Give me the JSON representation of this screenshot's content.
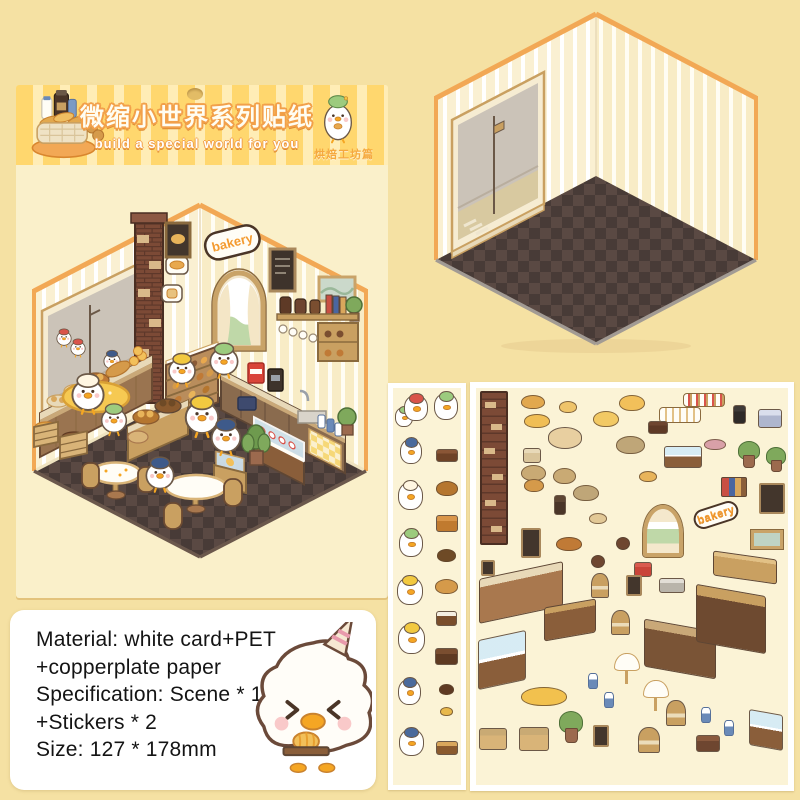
{
  "colors": {
    "page_bg": "#F5E1A3",
    "banner_yellow": "#FFD76E",
    "banner_pale": "#FFEDB6",
    "title_fill": "#FFFDF2",
    "title_outline": "#F2A04A",
    "edition_orange": "#F5A93F",
    "card_body": "#FAF0CA",
    "trim_orange": "#F2A855",
    "wall_cream": "#FAF0D2",
    "floor_dark": "#483B37",
    "floor_light": "#5A4943",
    "wood": "#A9784E",
    "sign_orange": "#F49A2E",
    "duck_white": "#FFFFFF",
    "sheet_bg": "#FBF3D6"
  },
  "banner": {
    "title": "微缩小世界系列贴纸",
    "subtitle": "build a special world for you",
    "edition": "烘焙工坊篇"
  },
  "scene": {
    "sign": "bakery"
  },
  "info_box": {
    "lines": [
      "Material: white card+PET",
      "+copperplate paper",
      "Specification: Scene * 1",
      "+Stickers * 2",
      "Size: 127 * 178mm"
    ]
  },
  "sticker_sheets": {
    "sheet_small": {
      "items": [
        {
          "n": "duck-green-small",
          "t": "duck",
          "c": "#9CCB7E",
          "x": 1,
          "y": 18,
          "w": 18,
          "h": 20
        },
        {
          "n": "duck-red-beret",
          "t": "duck",
          "c": "#D9534A",
          "x": 10,
          "y": 6,
          "w": 24,
          "h": 26
        },
        {
          "n": "duck-green-beret",
          "t": "duck",
          "c": "#9CCB7E",
          "x": 40,
          "y": 4,
          "w": 24,
          "h": 27
        },
        {
          "n": "duck-navy-cap",
          "t": "duck",
          "c": "#4A6A9C",
          "x": 6,
          "y": 50,
          "w": 22,
          "h": 25
        },
        {
          "n": "chocolate-tray",
          "t": "box",
          "c": "#6E4226",
          "c2": "#8A5636",
          "x": 42,
          "y": 60,
          "w": 22,
          "h": 13
        },
        {
          "n": "duck-cream-hat",
          "t": "duck",
          "c": "#FFF6E2",
          "x": 4,
          "y": 93,
          "w": 25,
          "h": 28
        },
        {
          "n": "bread-rolls",
          "t": "blob",
          "c": "#B5762F",
          "x": 42,
          "y": 92,
          "w": 22,
          "h": 15
        },
        {
          "n": "waffle-stack",
          "t": "box",
          "c": "#C07A2F",
          "c2": "#D9954A",
          "x": 42,
          "y": 126,
          "w": 22,
          "h": 17
        },
        {
          "n": "duck-green-eating",
          "t": "duck",
          "c": "#9CCB7E",
          "x": 5,
          "y": 141,
          "w": 24,
          "h": 27
        },
        {
          "n": "cookies",
          "t": "blob",
          "c": "#6E4A26",
          "x": 43,
          "y": 160,
          "w": 19,
          "h": 13
        },
        {
          "n": "duck-yellow-beret",
          "t": "duck",
          "c": "#F2C940",
          "x": 3,
          "y": 188,
          "w": 26,
          "h": 28
        },
        {
          "n": "croissants",
          "t": "blob",
          "c": "#D59A4A",
          "x": 41,
          "y": 190,
          "w": 23,
          "h": 15
        },
        {
          "n": "cupcakes-pair",
          "t": "box",
          "c": "#7A4E2C",
          "c2": "#F5EFE2",
          "x": 42,
          "y": 222,
          "w": 21,
          "h": 15
        },
        {
          "n": "duck-with-bag",
          "t": "duck",
          "c": "#F2C940",
          "x": 4,
          "y": 235,
          "w": 27,
          "h": 30
        },
        {
          "n": "chocolate-bars",
          "t": "box",
          "c": "#5E3A22",
          "c2": "#7A4E30",
          "x": 41,
          "y": 259,
          "w": 23,
          "h": 17
        },
        {
          "n": "duck-sailor",
          "t": "duck",
          "c": "#4A6A9C",
          "x": 4,
          "y": 290,
          "w": 23,
          "h": 26
        },
        {
          "n": "choco-drops",
          "t": "blob",
          "c": "#5E3A22",
          "x": 45,
          "y": 295,
          "w": 15,
          "h": 11
        },
        {
          "n": "butter-slices",
          "t": "blob",
          "c": "#E8B84B",
          "x": 46,
          "y": 318,
          "w": 13,
          "h": 9
        },
        {
          "n": "duck-waving",
          "t": "duck",
          "c": "#4A6A9C",
          "x": 5,
          "y": 340,
          "w": 25,
          "h": 27
        },
        {
          "n": "bread-loaf",
          "t": "box",
          "c": "#8A5A2E",
          "c2": "#D9A75C",
          "x": 42,
          "y": 352,
          "w": 22,
          "h": 14
        }
      ]
    },
    "sheet_large": {
      "items": [
        {
          "n": "brick-column",
          "t": "column",
          "x": 3,
          "y": 2,
          "w": 28,
          "h": 154
        },
        {
          "n": "bread-pair",
          "t": "blob",
          "c": "#E2A84E",
          "x": 44,
          "y": 6,
          "w": 24,
          "h": 14
        },
        {
          "n": "cupcake-duo",
          "t": "blob",
          "c": "#EFC46A",
          "x": 82,
          "y": 12,
          "w": 18,
          "h": 12
        },
        {
          "n": "buns-trio",
          "t": "blob",
          "c": "#F0BE55",
          "x": 47,
          "y": 25,
          "w": 26,
          "h": 14
        },
        {
          "n": "buns-quad",
          "t": "blob",
          "c": "#F2C964",
          "x": 116,
          "y": 22,
          "w": 26,
          "h": 16
        },
        {
          "n": "big-buns",
          "t": "blob",
          "c": "#F2C05A",
          "x": 142,
          "y": 6,
          "w": 26,
          "h": 16
        },
        {
          "n": "picnic-table",
          "t": "table",
          "c": "#E8CFA0",
          "x": 71,
          "y": 38,
          "w": 34,
          "h": 22
        },
        {
          "n": "cupcake-row-white",
          "t": "cuprow",
          "x": 182,
          "y": 18,
          "w": 42,
          "h": 16
        },
        {
          "n": "cupcake-row-berry",
          "t": "cuprow2",
          "x": 206,
          "y": 4,
          "w": 42,
          "h": 14
        },
        {
          "n": "kitchen-scale",
          "t": "box",
          "c": "#2E2A28",
          "c2": "#3E3A38",
          "x": 256,
          "y": 16,
          "w": 13,
          "h": 19
        },
        {
          "n": "cash-register",
          "t": "box",
          "c": "#AEB6CE",
          "c2": "#D9DEEC",
          "x": 281,
          "y": 20,
          "w": 24,
          "h": 19
        },
        {
          "n": "jar-cabinet",
          "t": "box",
          "c": "#5E3A26",
          "c2": "#6E4630",
          "x": 171,
          "y": 32,
          "w": 20,
          "h": 13
        },
        {
          "n": "jar-basket",
          "t": "box",
          "c": "#D9C49A",
          "c2": "#E8D9B8",
          "x": 46,
          "y": 59,
          "w": 18,
          "h": 15
        },
        {
          "n": "flour-sack-1",
          "t": "blob",
          "c": "#C9AA74",
          "x": 44,
          "y": 76,
          "w": 25,
          "h": 16
        },
        {
          "n": "flour-sack-2",
          "t": "blob",
          "c": "#C9AA74",
          "x": 76,
          "y": 79,
          "w": 23,
          "h": 16
        },
        {
          "n": "dough-mat",
          "t": "blob",
          "c": "#BFA678",
          "x": 139,
          "y": 47,
          "w": 29,
          "h": 18
        },
        {
          "n": "sandwich-case",
          "t": "case",
          "x": 187,
          "y": 57,
          "w": 38,
          "h": 22
        },
        {
          "n": "sushi-rolls",
          "t": "blob",
          "c": "#D9A0A8",
          "x": 227,
          "y": 50,
          "w": 22,
          "h": 11
        },
        {
          "n": "plant-1",
          "t": "plant",
          "x": 261,
          "y": 52,
          "w": 20,
          "h": 27
        },
        {
          "n": "plant-2",
          "t": "plant",
          "x": 289,
          "y": 58,
          "w": 18,
          "h": 25
        },
        {
          "n": "croissant-pair",
          "t": "blob",
          "c": "#D59A4A",
          "x": 47,
          "y": 90,
          "w": 20,
          "h": 13
        },
        {
          "n": "mini-buns",
          "t": "blob",
          "c": "#E8B45A",
          "x": 162,
          "y": 82,
          "w": 18,
          "h": 11
        },
        {
          "n": "books-stack",
          "t": "books",
          "x": 244,
          "y": 88,
          "w": 26,
          "h": 20
        },
        {
          "n": "menu-chalkboard",
          "t": "board",
          "x": 282,
          "y": 94,
          "w": 26,
          "h": 31
        },
        {
          "n": "dough-mat-2",
          "t": "blob",
          "c": "#BFA678",
          "x": 96,
          "y": 96,
          "w": 26,
          "h": 16
        },
        {
          "n": "pepper-grinders",
          "t": "box",
          "c": "#4A3528",
          "c2": "#5E4634",
          "x": 77,
          "y": 106,
          "w": 12,
          "h": 20
        },
        {
          "n": "cutting-board",
          "t": "blob",
          "c": "#E2C896",
          "x": 112,
          "y": 124,
          "w": 18,
          "h": 11
        },
        {
          "n": "arch-window",
          "t": "arch",
          "x": 166,
          "y": 116,
          "w": 40,
          "h": 52
        },
        {
          "n": "bakery-sign",
          "t": "sign",
          "label": "bakery",
          "x": 216,
          "y": 116,
          "w": 46,
          "h": 20,
          "r": -18
        },
        {
          "n": "landscape-frame",
          "t": "frame",
          "x": 274,
          "y": 141,
          "w": 32,
          "h": 19
        },
        {
          "n": "duck-portrait",
          "t": "board",
          "x": 44,
          "y": 139,
          "w": 20,
          "h": 30
        },
        {
          "n": "bread-basket",
          "t": "blob",
          "c": "#C07A36",
          "x": 79,
          "y": 148,
          "w": 26,
          "h": 14
        },
        {
          "n": "stool-1",
          "t": "round",
          "c": "#6E4630",
          "x": 139,
          "y": 148,
          "w": 14,
          "h": 13
        },
        {
          "n": "stool-2",
          "t": "round",
          "c": "#6E4630",
          "x": 114,
          "y": 166,
          "w": 14,
          "h": 13
        },
        {
          "n": "radio",
          "t": "box",
          "c": "#C94438",
          "c2": "#D95A4E",
          "x": 157,
          "y": 173,
          "w": 18,
          "h": 15
        },
        {
          "n": "wall-cabinet",
          "t": "counter",
          "c": "#C9A061",
          "c2": "#E2C186",
          "x": 236,
          "y": 166,
          "w": 64,
          "h": 25,
          "s": 8
        },
        {
          "n": "photo-frame",
          "t": "board",
          "x": 4,
          "y": 171,
          "w": 14,
          "h": 16
        },
        {
          "n": "long-counter",
          "t": "counter",
          "c": "#A9784E",
          "c2": "#E8D9B8",
          "x": 2,
          "y": 181,
          "w": 84,
          "h": 45,
          "s": -12
        },
        {
          "n": "cafe-chair-1",
          "t": "chair",
          "c": "#C9A061",
          "x": 114,
          "y": 184,
          "w": 18,
          "h": 25
        },
        {
          "n": "easel-frame",
          "t": "board",
          "x": 149,
          "y": 186,
          "w": 16,
          "h": 21
        },
        {
          "n": "sink-unit",
          "t": "box",
          "c": "#B9B4AA",
          "c2": "#E2DED6",
          "x": 182,
          "y": 189,
          "w": 26,
          "h": 15
        },
        {
          "n": "booth-bench",
          "t": "counter",
          "c": "#8A5E3A",
          "c2": "#C9A061",
          "x": 67,
          "y": 214,
          "w": 52,
          "h": 34,
          "s": -10
        },
        {
          "n": "cafe-chair-2",
          "t": "chair",
          "c": "#C9A061",
          "x": 134,
          "y": 221,
          "w": 19,
          "h": 25
        },
        {
          "n": "curved-counter",
          "t": "counter",
          "c": "#7A5436",
          "c2": "#C9A878",
          "x": 167,
          "y": 236,
          "w": 72,
          "h": 48,
          "s": 10
        },
        {
          "n": "shelf-unit",
          "t": "counter",
          "c": "#6E4A30",
          "c2": "#C9A061",
          "x": 219,
          "y": 201,
          "w": 70,
          "h": 58,
          "s": 10
        },
        {
          "n": "bread-display-case",
          "t": "case",
          "x": 1,
          "y": 246,
          "w": 48,
          "h": 50,
          "s": -12
        },
        {
          "n": "umbrella-1",
          "t": "umbrella",
          "x": 137,
          "y": 264,
          "w": 24,
          "h": 31
        },
        {
          "n": "umbrella-2",
          "t": "umbrella",
          "x": 166,
          "y": 291,
          "w": 24,
          "h": 31
        },
        {
          "n": "yellow-rug",
          "t": "blob",
          "c": "#F2C14E",
          "x": 44,
          "y": 298,
          "w": 46,
          "h": 19
        },
        {
          "n": "milk-bottles-1",
          "t": "bottle",
          "x": 111,
          "y": 284,
          "w": 10,
          "h": 16
        },
        {
          "n": "milk-bottles-2",
          "t": "bottle",
          "x": 127,
          "y": 303,
          "w": 10,
          "h": 16
        },
        {
          "n": "milk-bottles-3",
          "t": "bottle",
          "x": 224,
          "y": 318,
          "w": 10,
          "h": 16
        },
        {
          "n": "milk-bottles-4",
          "t": "bottle",
          "x": 247,
          "y": 331,
          "w": 10,
          "h": 16
        },
        {
          "n": "potted-palm",
          "t": "plant",
          "x": 82,
          "y": 322,
          "w": 22,
          "h": 32
        },
        {
          "n": "bread-crate-1",
          "t": "box",
          "c": "#D9B478",
          "c2": "#C9AA74",
          "x": 2,
          "y": 339,
          "w": 28,
          "h": 22
        },
        {
          "n": "bread-crate-2",
          "t": "box",
          "c": "#D9B478",
          "c2": "#C9AA74",
          "x": 42,
          "y": 338,
          "w": 30,
          "h": 24
        },
        {
          "n": "duck-portrait-2",
          "t": "board",
          "x": 116,
          "y": 336,
          "w": 16,
          "h": 22
        },
        {
          "n": "cafe-chair-3",
          "t": "chair",
          "c": "#C9A061",
          "x": 161,
          "y": 338,
          "w": 22,
          "h": 26
        },
        {
          "n": "cafe-chair-4",
          "t": "chair",
          "c": "#C9A061",
          "x": 189,
          "y": 311,
          "w": 20,
          "h": 26
        },
        {
          "n": "coffee-grinders",
          "t": "box",
          "c": "#6E4630",
          "c2": "#8A5A3E",
          "x": 219,
          "y": 346,
          "w": 24,
          "h": 17
        },
        {
          "n": "mini-display-cart",
          "t": "case",
          "x": 272,
          "y": 323,
          "w": 34,
          "h": 36,
          "s": 10
        }
      ]
    }
  }
}
